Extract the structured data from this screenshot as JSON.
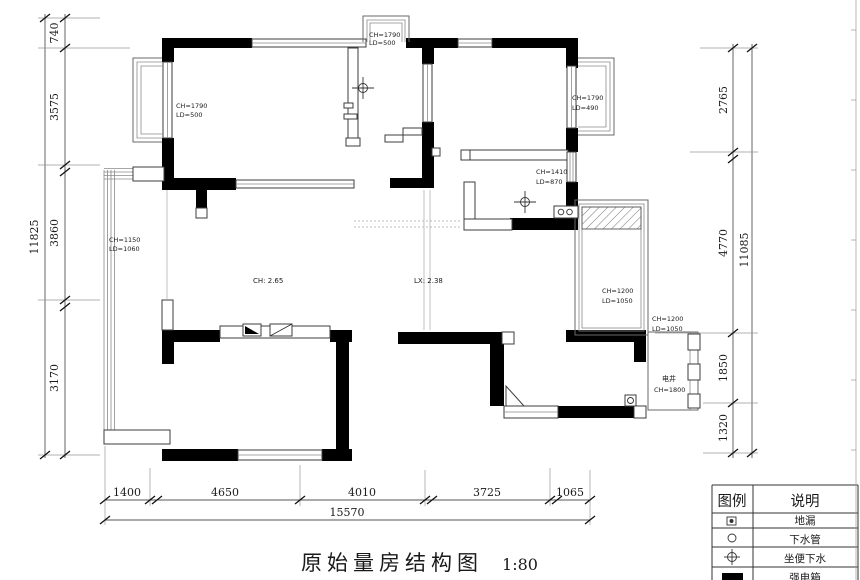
{
  "title": {
    "text": "原始量房结构图",
    "scale": "1:80"
  },
  "plan_labels": {
    "bay_top": {
      "ch": "CH=1790",
      "ld": "LD=500"
    },
    "room_topleft": {
      "ch": "CH=1790",
      "ld": "LD=500"
    },
    "balcony_left": {
      "ch": "CH=1150",
      "ld": "LD=1060"
    },
    "bay_right": {
      "ch": "CH=1790",
      "ld": "LD=490"
    },
    "bathroom": {
      "ch": "CH=1410",
      "ld": "LD=870"
    },
    "living_height": "CH: 2.65",
    "beam_height": "LX: 2.38",
    "balcony_right_upper": {
      "ch": "CH=1200",
      "ld": "LD=1050"
    },
    "balcony_right_lower": {
      "ch": "CH=1200",
      "ld": "LD=1050"
    },
    "shaft": {
      "name": "电井",
      "ch": "CH=1800"
    }
  },
  "dimensions": {
    "left": {
      "segments": [
        "740",
        "3575",
        "3860",
        "3170"
      ],
      "total": "11825"
    },
    "right": {
      "segments": [
        "2765",
        "4770",
        "1850",
        "1320"
      ],
      "total": "11085"
    },
    "bottom": {
      "segments": [
        "1400",
        "4650",
        "4010",
        "3725",
        "1065"
      ],
      "total": "15570"
    }
  },
  "legend": {
    "col_symbol": "图例",
    "col_desc": "说明",
    "rows": [
      {
        "icon": "floor-drain-icon",
        "desc": "地漏"
      },
      {
        "icon": "drain-pipe-icon",
        "desc": "下水管"
      },
      {
        "icon": "toilet-drain-icon",
        "desc": "坐便下水"
      },
      {
        "icon": "electric-box-icon",
        "desc": "强电箱"
      }
    ]
  }
}
